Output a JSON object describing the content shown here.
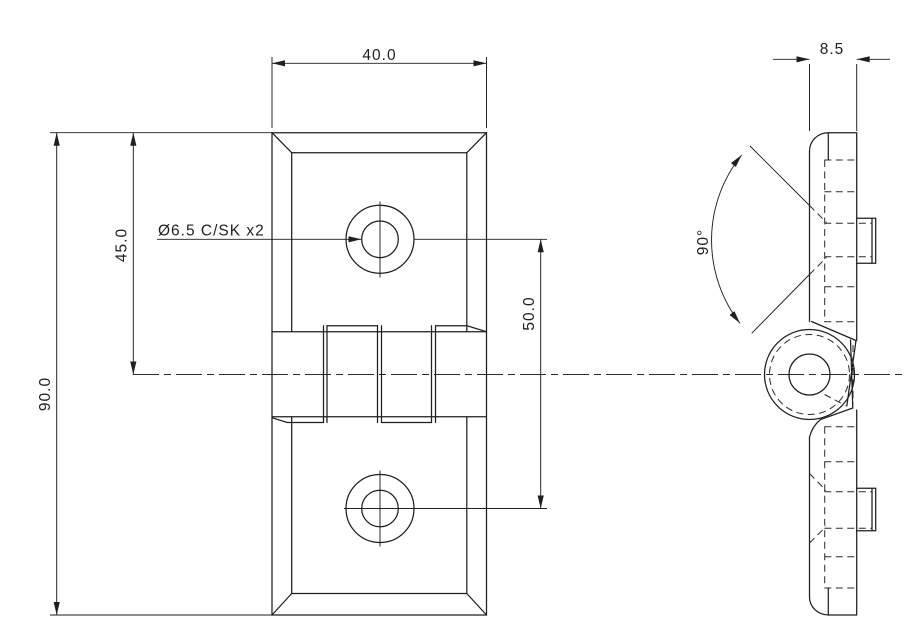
{
  "drawing": {
    "labels": {
      "plate_width": "40.0",
      "plate_height": "90.0",
      "hole_offset_top": "45.0",
      "hole_spacing": "50.0",
      "thickness": "8.5",
      "countersink_angle": "90°",
      "hole_callout": "Ø6.5 C/SK x2"
    }
  }
}
